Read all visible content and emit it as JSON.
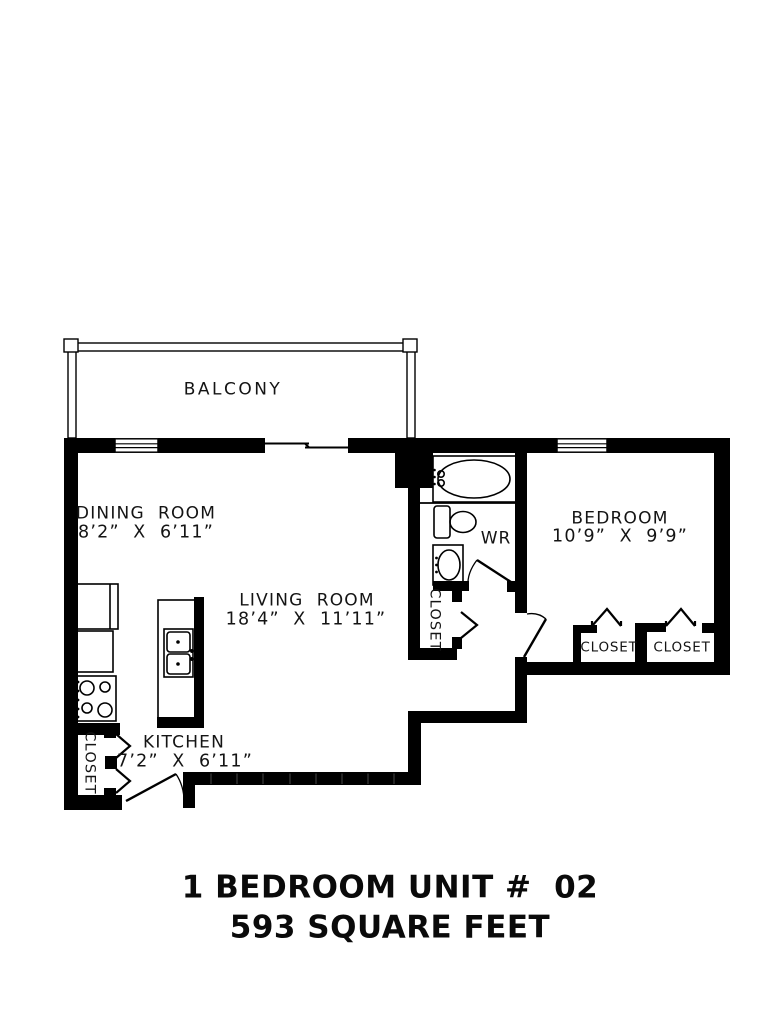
{
  "balcony": {
    "label": "BALCONY"
  },
  "rooms": {
    "dining": {
      "name": "DINING  ROOM",
      "dims": "8’2”  X  6’11”"
    },
    "living": {
      "name": "LIVING  ROOM",
      "dims": "18’4”  X  11’11”"
    },
    "bedroom": {
      "name": "BEDROOM",
      "dims": "10’9”  X  9’9”"
    },
    "kitchen": {
      "name": "KITCHEN",
      "dims": "7’2”  X  6’11”"
    },
    "washroom": {
      "label": "WR"
    }
  },
  "closets": {
    "hall": "CLOSET",
    "kitchen": "CLOSET",
    "bedroom_left": "CLOSET",
    "bedroom_right": "CLOSET"
  },
  "title": {
    "line1": "1 BEDROOM UNIT #  02",
    "line2": "593 SQUARE FEET"
  },
  "colors": {
    "walls": "#000000",
    "background": "#ffffff",
    "text": "#141414"
  }
}
